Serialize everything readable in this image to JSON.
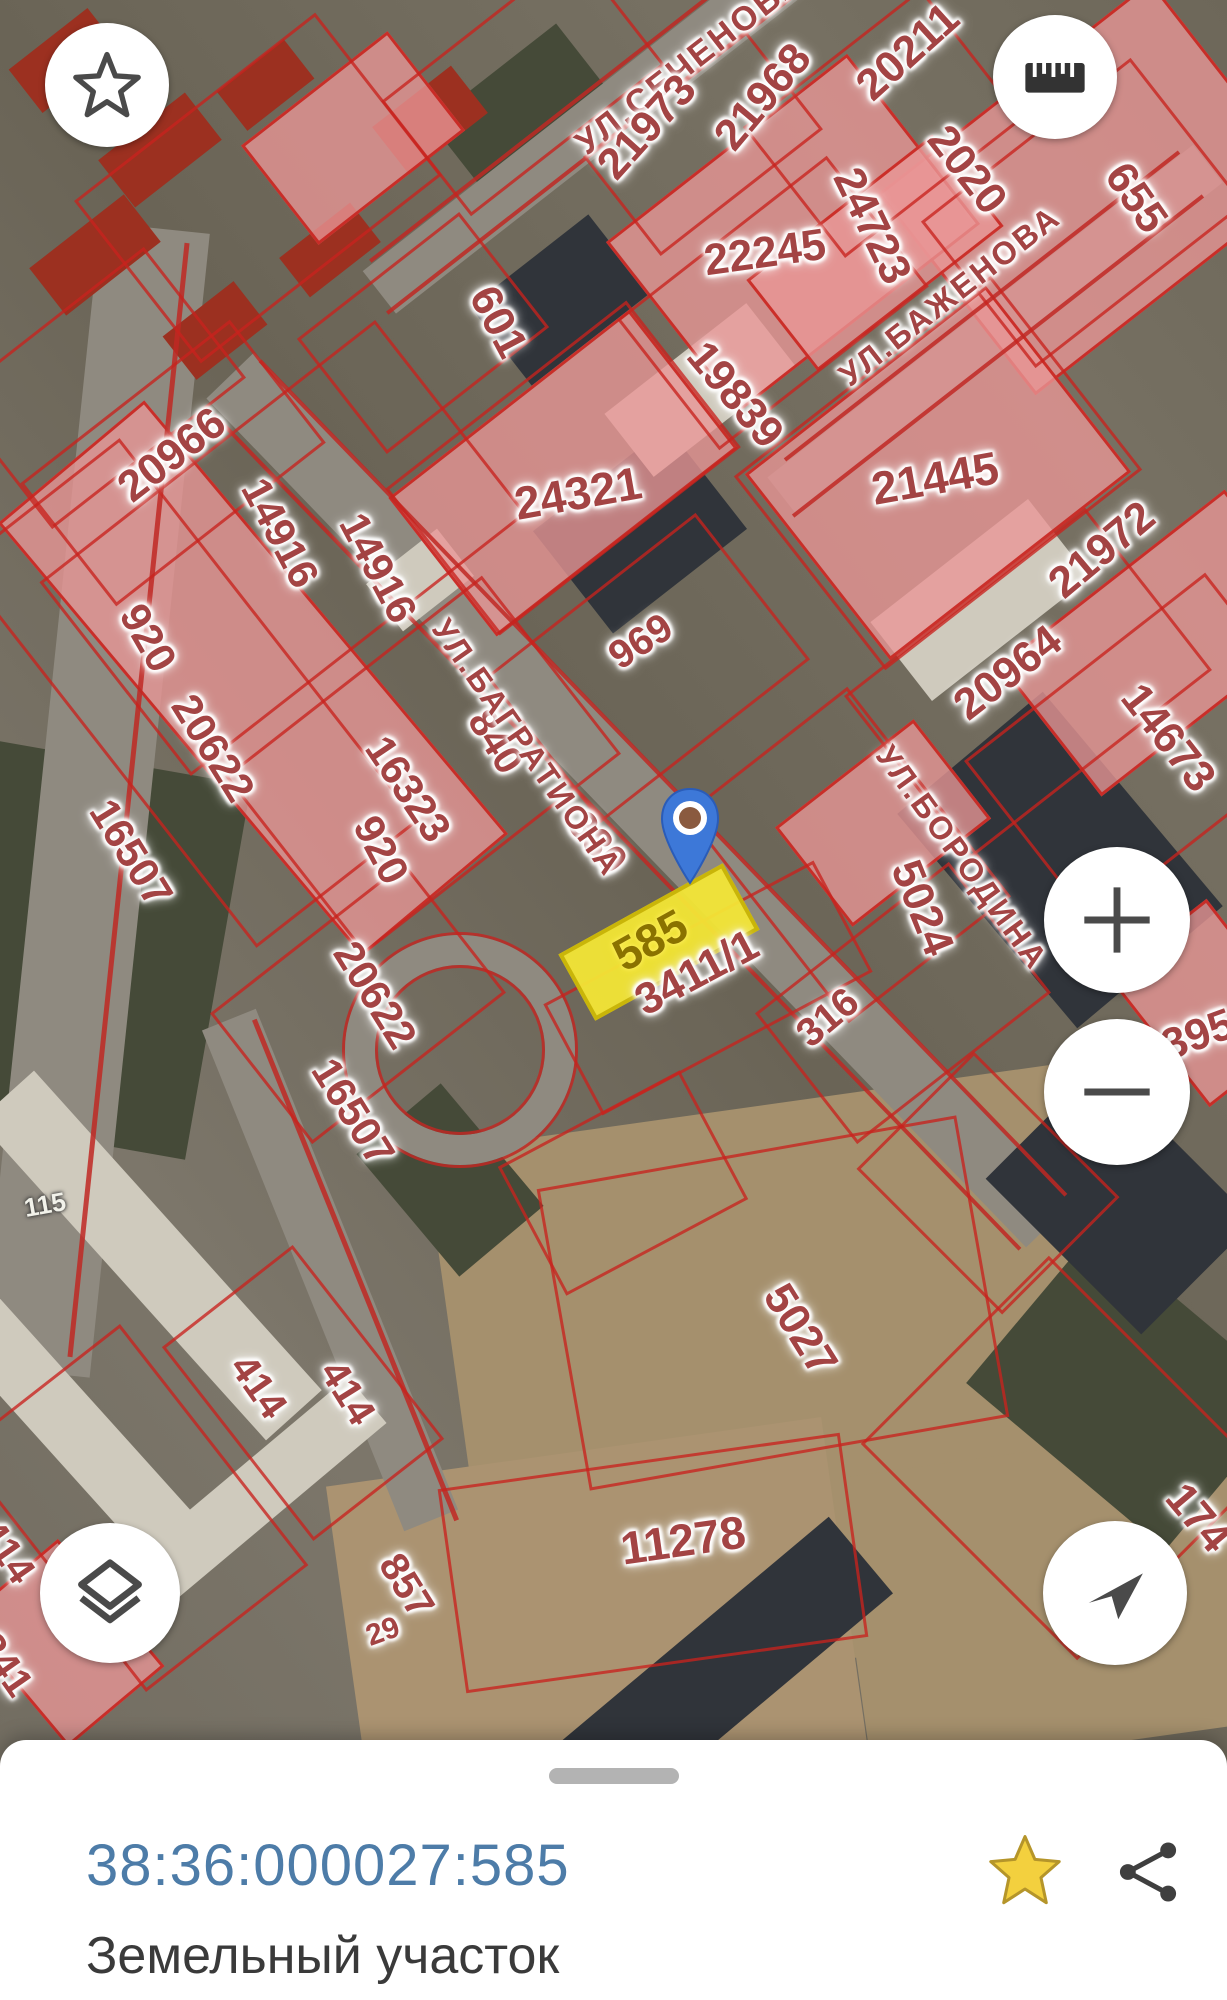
{
  "map": {
    "labels": [
      {
        "t": "УЛ.СЕЧЕНОВА",
        "x": 690,
        "y": 62,
        "r": -38,
        "s": 34,
        "c": "street"
      },
      {
        "t": "21973",
        "x": 647,
        "y": 127,
        "r": -48,
        "s": 44
      },
      {
        "t": "21968",
        "x": 763,
        "y": 97,
        "r": -50,
        "s": 44
      },
      {
        "t": "20211",
        "x": 908,
        "y": 52,
        "r": -42,
        "s": 44
      },
      {
        "t": "2020",
        "x": 967,
        "y": 170,
        "r": 52,
        "s": 44
      },
      {
        "t": "655",
        "x": 1136,
        "y": 198,
        "r": 55,
        "s": 44
      },
      {
        "t": "22245",
        "x": 765,
        "y": 253,
        "r": -8,
        "s": 44
      },
      {
        "t": "24723",
        "x": 872,
        "y": 226,
        "r": 64,
        "s": 44
      },
      {
        "t": "УЛ.БАЖЕНОВА",
        "x": 950,
        "y": 296,
        "r": -38,
        "s": 32,
        "c": "street"
      },
      {
        "t": "601",
        "x": 498,
        "y": 322,
        "r": 62,
        "s": 44
      },
      {
        "t": "19839",
        "x": 735,
        "y": 395,
        "r": 50,
        "s": 44
      },
      {
        "t": "24321",
        "x": 578,
        "y": 493,
        "r": -10,
        "s": 46
      },
      {
        "t": "21445",
        "x": 935,
        "y": 478,
        "r": -10,
        "s": 46
      },
      {
        "t": "20966",
        "x": 172,
        "y": 455,
        "r": -38,
        "s": 44
      },
      {
        "t": "14916",
        "x": 280,
        "y": 533,
        "r": 62,
        "s": 42
      },
      {
        "t": "14916",
        "x": 378,
        "y": 568,
        "r": 62,
        "s": 42
      },
      {
        "t": "920",
        "x": 148,
        "y": 638,
        "r": 60,
        "s": 42
      },
      {
        "t": "20622",
        "x": 213,
        "y": 748,
        "r": 58,
        "s": 42
      },
      {
        "t": "16507",
        "x": 131,
        "y": 853,
        "r": 58,
        "s": 42
      },
      {
        "t": "16323",
        "x": 408,
        "y": 789,
        "r": 56,
        "s": 42
      },
      {
        "t": "920",
        "x": 381,
        "y": 850,
        "r": 62,
        "s": 42
      },
      {
        "t": "20622",
        "x": 375,
        "y": 995,
        "r": 58,
        "s": 42
      },
      {
        "t": "16507",
        "x": 353,
        "y": 1112,
        "r": 58,
        "s": 42
      },
      {
        "t": "840",
        "x": 495,
        "y": 742,
        "r": 58,
        "s": 40
      },
      {
        "t": "380",
        "x": 597,
        "y": 843,
        "r": 50,
        "s": 40
      },
      {
        "t": "969",
        "x": 641,
        "y": 642,
        "r": -33,
        "s": 40
      },
      {
        "t": "УЛ.БАГРАТИОНА",
        "x": 527,
        "y": 748,
        "r": 55,
        "s": 32,
        "c": "street"
      },
      {
        "t": "УЛ.БОРОДИНА",
        "x": 962,
        "y": 858,
        "r": 54,
        "s": 32,
        "c": "street"
      },
      {
        "t": "3411/1",
        "x": 697,
        "y": 973,
        "r": -28,
        "s": 44
      },
      {
        "t": "20964",
        "x": 1008,
        "y": 673,
        "r": -38,
        "s": 44
      },
      {
        "t": "21972",
        "x": 1102,
        "y": 550,
        "r": -40,
        "s": 44
      },
      {
        "t": "14673",
        "x": 1168,
        "y": 738,
        "r": 52,
        "s": 44
      },
      {
        "t": "5024",
        "x": 922,
        "y": 908,
        "r": 68,
        "s": 44
      },
      {
        "t": "316",
        "x": 828,
        "y": 1018,
        "r": -40,
        "s": 40
      },
      {
        "t": "395",
        "x": 1198,
        "y": 1035,
        "r": -20,
        "s": 44
      },
      {
        "t": "5027",
        "x": 800,
        "y": 1330,
        "r": 58,
        "s": 44
      },
      {
        "t": "11278",
        "x": 683,
        "y": 1540,
        "r": -8,
        "s": 46
      },
      {
        "t": "414",
        "x": 258,
        "y": 1387,
        "r": 55,
        "s": 40
      },
      {
        "t": "414",
        "x": 347,
        "y": 1393,
        "r": 58,
        "s": 40
      },
      {
        "t": "857",
        "x": 406,
        "y": 1586,
        "r": 58,
        "s": 40
      },
      {
        "t": "29",
        "x": 383,
        "y": 1632,
        "r": -20,
        "s": 30
      },
      {
        "t": "174",
        "x": 1198,
        "y": 1518,
        "r": 50,
        "s": 44
      },
      {
        "t": "414",
        "x": 6,
        "y": 1552,
        "r": 55,
        "s": 40
      },
      {
        "t": "241",
        "x": 4,
        "y": 1665,
        "r": 55,
        "s": 40
      },
      {
        "t": "115",
        "x": 45,
        "y": 1205,
        "r": -10,
        "s": 26,
        "c": "white"
      },
      {
        "t": "585",
        "x": 650,
        "y": 940,
        "r": -29,
        "s": 46,
        "c": "selected"
      }
    ],
    "selected_parcel_number": "585",
    "selected_parcel_fill": "#f3e636",
    "pin_color": "#3d78d8",
    "boundary_color": "#c8231e"
  },
  "controls": {
    "favorite_icon": "star-outline",
    "measure_icon": "ruler",
    "zoom_in_icon": "plus",
    "zoom_out_icon": "minus",
    "layers_icon": "layers",
    "compass_icon": "navigation-arrow"
  },
  "bottom_sheet": {
    "cadastral_number": "38:36:000027:585",
    "object_type": "Земельный участок",
    "number_color": "#4d7ca8",
    "favorite_icon": "gold-star",
    "share_icon": "share"
  }
}
